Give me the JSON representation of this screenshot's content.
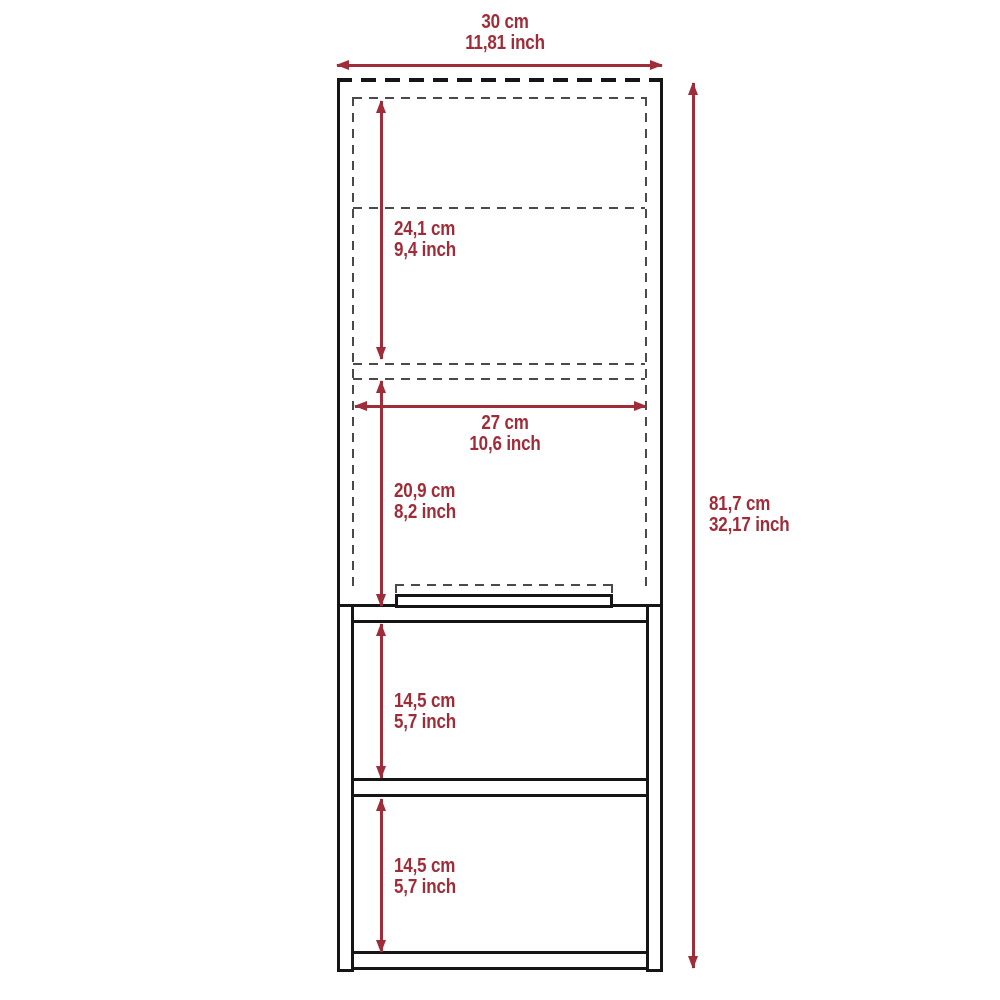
{
  "colors": {
    "dimension_red": "#9e2d39",
    "outline_black": "#151515",
    "hidden_edge_gray": "#4a4a4a",
    "background": "#ffffff"
  },
  "dims": {
    "overall_width": {
      "cm": "30 cm",
      "inch": "11,81 inch"
    },
    "overall_height": {
      "cm": "81,7 cm",
      "inch": "32,17 inch"
    },
    "upper_inner_height": {
      "cm": "24,1 cm",
      "inch": "9,4 inch"
    },
    "inner_width": {
      "cm": "27 cm",
      "inch": "10,6 inch"
    },
    "lower_inner_height": {
      "cm": "20,9 cm",
      "inch": "8,2 inch"
    },
    "open_shelf_1_height": {
      "cm": "14,5 cm",
      "inch": "5,7 inch"
    },
    "open_shelf_2_height": {
      "cm": "14,5 cm",
      "inch": "5,7 inch"
    }
  }
}
